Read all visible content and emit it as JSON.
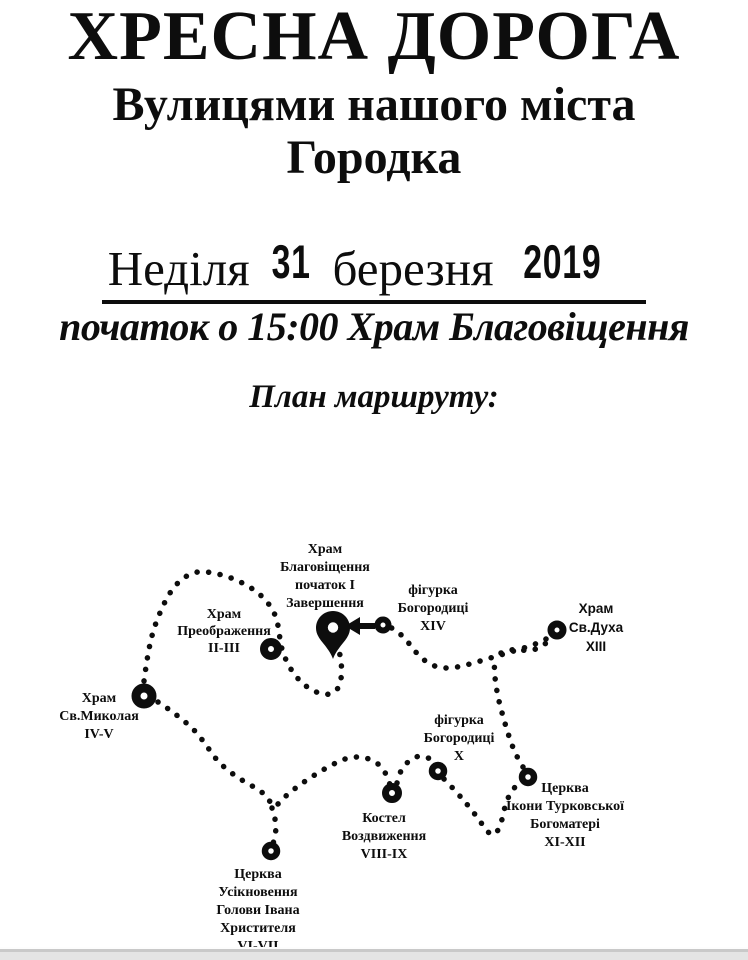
{
  "header": {
    "title": "ХРЕСНА ДОРОГА",
    "subtitle_line1": "Вулицями нашого міста",
    "subtitle_line2": "Городка",
    "date": {
      "weekday": "Неділя",
      "day": "31",
      "month": "березня",
      "year": "2019"
    },
    "start_line": "початок о 15:00 Храм Благовіщення",
    "map_heading": "План маршруту:"
  },
  "map": {
    "stations": [
      {
        "id": "blahovishchennia",
        "marker": "pin",
        "lines": [
          "Храм",
          "Благовіщення",
          "початок І",
          "Завершення"
        ]
      },
      {
        "id": "bohorodytsi-xiv",
        "marker": "ring",
        "lines": [
          "фігурка",
          "Богородиці",
          "XIV"
        ]
      },
      {
        "id": "sv-dukha",
        "marker": "ring",
        "lines": [
          "Храм",
          "Св.Духа",
          "XIII"
        ]
      },
      {
        "id": "preobrazhennia",
        "marker": "ring",
        "lines": [
          "Храм",
          "Преображення",
          "II-III"
        ]
      },
      {
        "id": "sv-mykolaia",
        "marker": "ring",
        "lines": [
          "Храм",
          "Св.Миколая",
          "IV-V"
        ]
      },
      {
        "id": "bohorodytsi-x",
        "marker": "ring",
        "lines": [
          "фігурка",
          "Богородиці",
          "X"
        ]
      },
      {
        "id": "turkovskoi",
        "marker": "ring",
        "lines": [
          "Церква",
          "Ікони Турковської",
          "Богоматері",
          "XI-XII"
        ]
      },
      {
        "id": "kostel",
        "marker": "ring",
        "lines": [
          "Костел",
          "Воздвиження",
          "VIII-IX"
        ]
      },
      {
        "id": "usiknovennia",
        "marker": "ring",
        "lines": [
          "Церква",
          "Усікновення",
          "Голови Івана",
          "Христителя",
          "VI-VII"
        ]
      }
    ]
  },
  "colors": {
    "ink": "#0d0d0d",
    "background": "#ffffff",
    "footer_strip": "#e4e4e4"
  }
}
